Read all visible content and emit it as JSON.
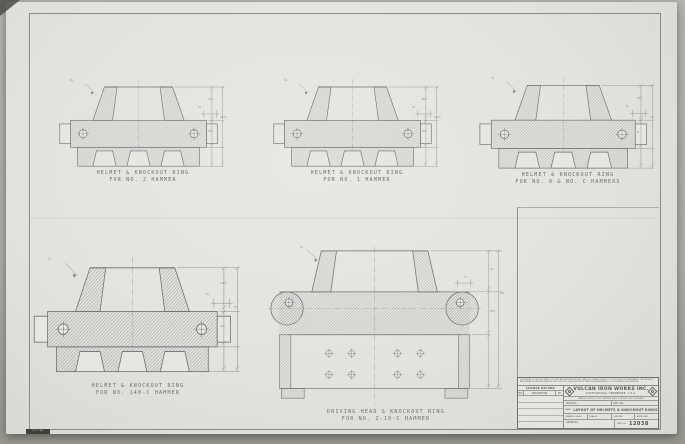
{
  "drawings": [
    {
      "caption1": "HELMET & KNOCKOUT RING",
      "caption2": "FOR NO. 2 HAMMER",
      "dims": {
        "top": "7⅝",
        "mid": "3½",
        "total": "12⅞",
        "small": "⅝",
        "leader": "⅜"
      }
    },
    {
      "caption1": "HELMET & KNOCKOUT RING",
      "caption2": "FOR NO. 1 HAMMER",
      "dims": {
        "top": "8¼",
        "mid": "3¾",
        "total": "13⅝",
        "small": "⅝",
        "leader": "⅜"
      }
    },
    {
      "caption1": "HELMET & KNOCKOUT RING",
      "caption2": "FOR NO. 0 & NO. C HAMMERS",
      "dims": {
        "top": "9½",
        "mid": "4",
        "total": "15",
        "small": "¾",
        "leader": "½"
      }
    },
    {
      "caption1": "HELMET & KNOCKOUT RING",
      "caption2": "FOR NO. 140-C HAMMER",
      "dims": {
        "top": "10½",
        "mid": "4½",
        "total": "17",
        "small": "¾",
        "leader": "½"
      }
    },
    {
      "caption1": "DRIVING HEAD & KNOCKOUT RING",
      "caption2": "FOR NO. 2-10-C HAMMER",
      "dims": {
        "top": "11",
        "mid": "5½",
        "total": "24",
        "small": "⅞",
        "leader": "⅝"
      }
    }
  ],
  "title_block": {
    "note": "THIS PRINT IS THE PROPERTY OF VULCAN IRON WORKS INC. AND IS LOANED SUBJECT TO RETURN UPON DEMAND. THE DESIGN AND DETAILS SHOWN HEREON MUST NOT BE USED WITHOUT WRITTEN PERMISSION OF VULCAN IRON WORKS INC.",
    "change_record": "CHANGE RECORD",
    "col_no": "NO.",
    "col_desc": "DESCRIPTION",
    "col_by": "BY",
    "company": "VULCAN IRON WORKS INC.",
    "location": "CHATTANOOGA, TENNESSEE, U.S.A.",
    "subnote": "MANUFACTURERS OF PILE HAMMERS AND CONTRACTORS EQUIPMENT",
    "cell_material": "MATERIAL",
    "cell_patt": "PATT. NO.",
    "name_label": "NAME",
    "title": "LAYOUT OF HELMETS & KNOCKOUT RINGS",
    "drawn_label": "DRAWN",
    "drawn_date": "4-28-43",
    "traced_label": "TRACED",
    "checked_label": "CHECKED",
    "approved_label": "APPROVED",
    "order_label": "ORDER NO.",
    "dwg_label": "DWG. NO.",
    "drawing_number": "12038"
  },
  "stamp": "VULCAN"
}
